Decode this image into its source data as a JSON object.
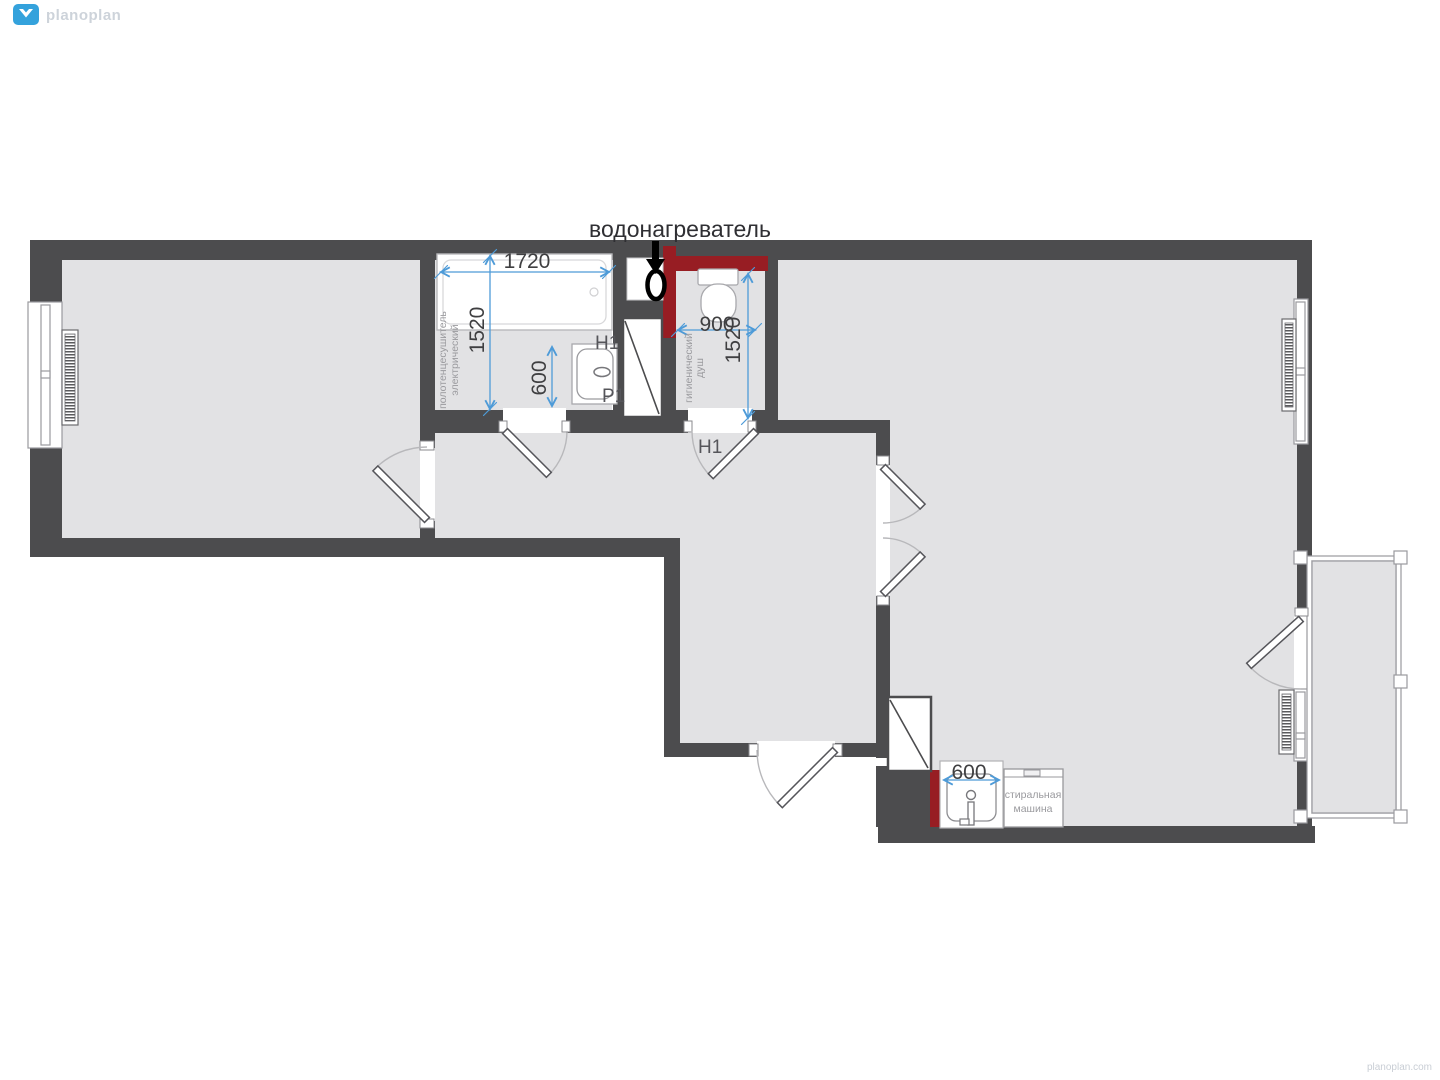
{
  "brand": {
    "logo_text": "planoplan",
    "logo_icon": "planoplan-diamond-icon",
    "watermark": "planoplan.com"
  },
  "annotation": {
    "water_heater": "водонагреватель"
  },
  "dimensions": {
    "bathtub_width": "1720",
    "bathroom_depth": "1520",
    "bath_sink_width": "600",
    "wc_width": "900",
    "wc_depth": "1520",
    "kitchen_sink_width": "600"
  },
  "labels": {
    "towel_rail_line1": "полотенцесушитель",
    "towel_rail_line2": "электрический",
    "shower_line1": "гигиенический",
    "shower_line2": "душ",
    "washing_machine_line1": "стиральная",
    "washing_machine_line2": "машина",
    "bath_sink_code_top": "H1",
    "bath_sink_code_bottom": "P1",
    "wc_door_code": "H1"
  },
  "colors": {
    "wall": "#4c4c4e",
    "floor": "#e2e2e4",
    "accent_red": "#971d23",
    "dimension_blue": "#4e9bd8",
    "label_gray": "#9a9a9e",
    "logo_blue": "#34a2dc",
    "logo_gray": "#cdd3da"
  }
}
